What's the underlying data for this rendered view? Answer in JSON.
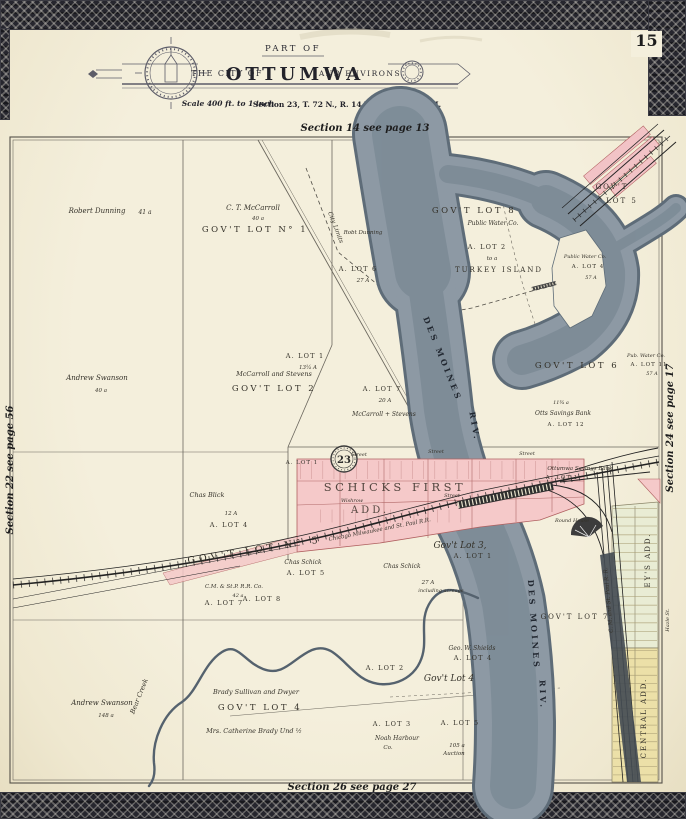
{
  "header": {
    "page_number": "15",
    "part_of": "PART OF",
    "the_city_of": "THE CITY OF",
    "city": "OTTUMWA",
    "and_environs": "AND ENVIRONS",
    "scale": "Scale 400 ft. to 1 inch",
    "section_line": "Section 23, T. 72 N., R. 14 W. of the 5th P. M."
  },
  "edges": {
    "top": "Section 14 see page 13",
    "bottom": "Section 26 see page 27",
    "left": "Section 22 see page 56",
    "right": "Section 24 see page 17"
  },
  "map": {
    "labels": {
      "robert_dunning": "Robert Dunning",
      "rd_acres": "41 a",
      "ct_mccarroll": "C. T. McCarroll",
      "ct_acres": "40 a",
      "govt_lot_no1": "GOV'T LOT N° 1",
      "robt_dunning": "Robt Dunning",
      "govt_lot_8": "GOV'T LOT 8",
      "public_water_co": "Public Water Co.",
      "a_lot_2": "A. LOT 2",
      "to_a": "to a",
      "turkey_island": "TURKEY ISLAND",
      "govt": "GOV'T",
      "lot_5": "LOT 5",
      "a_lot_4": "A. LOT 4",
      "acres_57": "57 A",
      "a_lot_6": "A. LOT 6",
      "acres_27": "27 A",
      "city_limits": "City Limits",
      "a_lot_1": "A. LOT 1",
      "acres_13": "13¼ A",
      "mccarroll_stevens": "McCarroll and Stevens",
      "govt_lot_2": "GOV'T LOT 2",
      "andrew_swanson": "Andrew Swanson",
      "acres_40": "40 a",
      "a_lot_7": "A. LOT 7",
      "acres_20": "20 A",
      "mccarroll_stevens2": "McCarroll + Stevens",
      "govt_lot_6": "GOV'T LOT 6",
      "pub_water_co": "Pub. Water Co.",
      "a_lot_11": "A. LOT 11",
      "otts_bank": "Otts Savings Bank",
      "a_lot_12": "A. LOT 12",
      "acres_11": "11¾ a",
      "ottumwa_bank": "Ottumwa Savings Bank",
      "des_moines": "DES MOINES",
      "riv": "RIV.",
      "schicks_first": "SCHICKS FIRST",
      "add": "ADD.",
      "wishrow": "Wishrow",
      "street": "Street",
      "govt_lot_no5": "GOV'T LOT N° 5",
      "chas_blick": "Chas Blick",
      "acres_12": "12 A",
      "govt_lot_3": "Gov't Lot 3,",
      "chas_schick": "Chas Schick",
      "a_lot_5": "A. LOT 5",
      "including": "including acreage",
      "cm_stp": "C.M. & St.P. R.R. Co.",
      "acres_42": "42 a",
      "a_lot_8": "A. LOT 8",
      "bear_creek": "Bear Creek",
      "brady": "Brady Sullivan and Dwyer",
      "govt_lot_4": "GOV'T LOT 4",
      "govt_lot_4s": "Gov't Lot 4",
      "catherine": "Mrs. Catherine Brady  Und ½",
      "acres_148": "148 a",
      "geo_shields": "Geo. W. Shields",
      "a_lot_3": "A. LOT 3",
      "noah": "Noah Harbour",
      "co": "Co.",
      "acres_105": "105 a",
      "auction": "Auction",
      "govt_lot_7": "GOV'T LOT 7",
      "round_house": "Round House",
      "stamp": "23",
      "chicago_rr": "Chicago Milwaukee and St. Paul R.R.",
      "st_paul_rr": "C. M. and St. Paul R. R.",
      "hazle": "Hazle St.",
      "central_add": "CENTRAL ADD.",
      "eys_add": "EY'S ADD."
    },
    "colors": {
      "paper": "#f2ecd8",
      "water": "#8d99a4",
      "water_bank": "#5e6c78",
      "addition_pink": "#f5c9c9",
      "addition_yellow": "#ece0a8",
      "addition_green": "#e9ecd4",
      "border_lace": "#26262e",
      "rail": "#222222"
    }
  }
}
